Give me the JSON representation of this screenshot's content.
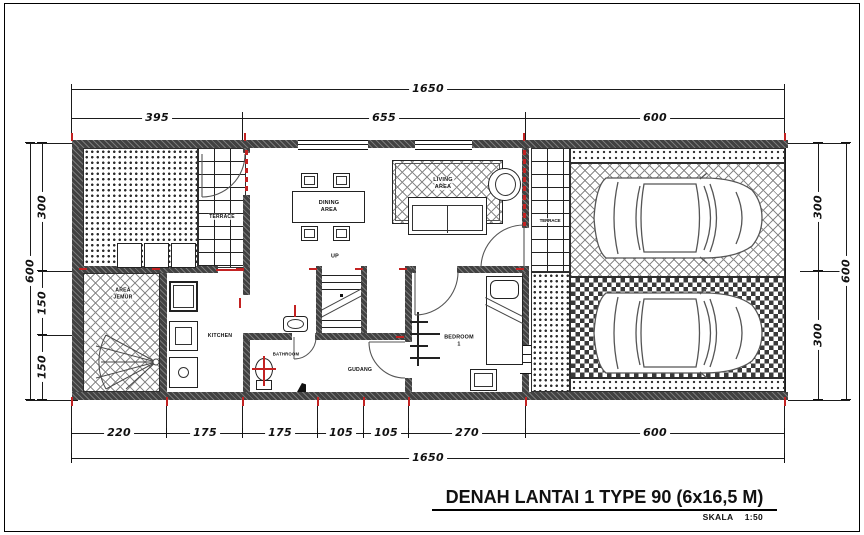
{
  "drawing": {
    "title": "DENAH LANTAI 1 TYPE 90 (6x16,5 M)",
    "scale_label": "SKALA",
    "scale_value": "1:50"
  },
  "dimensions": {
    "top": {
      "total": "1650",
      "segments": [
        "395",
        "655",
        "600"
      ]
    },
    "bottom": {
      "total": "1650",
      "segments": [
        "220",
        "175",
        "175",
        "105",
        "105",
        "270",
        "600"
      ]
    },
    "left": {
      "total": "600",
      "segments": [
        "300",
        "150",
        "150"
      ]
    },
    "right": {
      "total": "600",
      "segments": [
        "300",
        "300"
      ]
    }
  },
  "rooms": {
    "terrace_left": "TERRACE",
    "terrace_right": "TERRACE",
    "dining_line1": "DINING",
    "dining_line2": "AREA",
    "living_line1": "LIVING",
    "living_line2": "AREA",
    "jemur_line1": "AREA",
    "jemur_line2": "JEMUR",
    "kitchen": "KITCHEN",
    "bathroom": "BATHROOM",
    "gudang": "GUDANG",
    "bedroom_line1": "BEDROOM",
    "bedroom_line2": "1",
    "stairs": "UP"
  },
  "colors": {
    "line": "#1a1a1a",
    "wall": "#414141",
    "red_accent": "#c32222",
    "paper": "#ffffff"
  }
}
